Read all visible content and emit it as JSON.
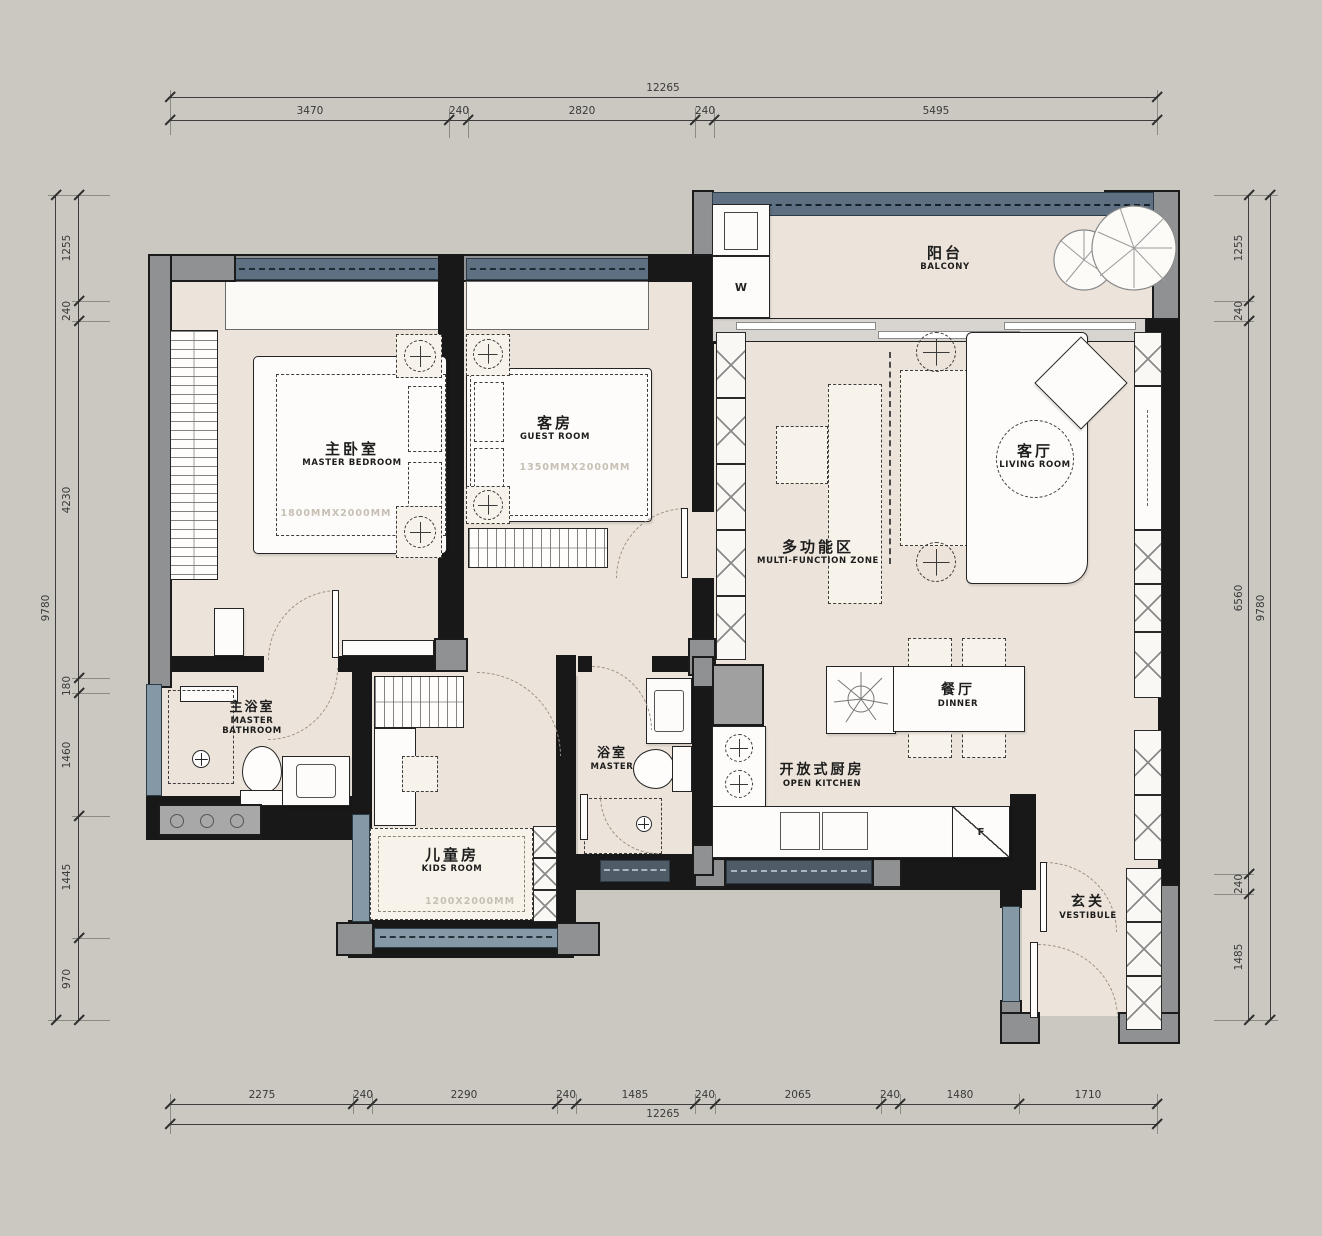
{
  "dims": {
    "top": {
      "total": "12265",
      "segments": [
        "3470",
        "240",
        "2820",
        "240",
        "5495"
      ]
    },
    "bottom": {
      "total": "12265",
      "segments": [
        "2275",
        "240",
        "2290",
        "240",
        "1485",
        "240",
        "2065",
        "240",
        "1480",
        "1710"
      ]
    },
    "left": {
      "total": "9780",
      "segments": [
        "1255",
        "240",
        "4230",
        "180",
        "1460",
        "1445",
        "970"
      ]
    },
    "right": {
      "total": "9780",
      "segments": [
        "1255",
        "240",
        "6560",
        "240",
        "1485"
      ]
    }
  },
  "rooms": {
    "master_bedroom": {
      "zh": "主卧室",
      "en": "MASTER BEDROOM",
      "bed_size": "1800MMX2000MM"
    },
    "guest_room": {
      "zh": "客房",
      "en": "GUEST ROOM",
      "bed_size": "1350MMX2000MM"
    },
    "balcony": {
      "zh": "阳台",
      "en": "BALCONY"
    },
    "living_room": {
      "zh": "客厅",
      "en": "LIVING ROOM"
    },
    "multi_function": {
      "zh": "多功能区",
      "en": "MULTI-FUNCTION ZONE"
    },
    "master_bathroom": {
      "zh": "主浴室",
      "en_line1": "MASTER",
      "en_line2": "BATHROOM"
    },
    "bathroom": {
      "zh": "浴室",
      "en": "MASTER"
    },
    "kids_room": {
      "zh": "儿童房",
      "en": "KIDS ROOM",
      "bed_size": "1200X2000MM"
    },
    "dining": {
      "zh": "餐厅",
      "en": "DINNER"
    },
    "kitchen": {
      "zh": "开放式厨房",
      "en": "OPEN KITCHEN"
    },
    "vestibule": {
      "zh": "玄关",
      "en": "VESTIBULE"
    }
  },
  "appliances": {
    "washer": "W",
    "fridge": "F"
  },
  "colors": {
    "background": "#cbc7c1",
    "floor": "#ece4da",
    "wall": "#181818",
    "column": "#8f9192",
    "window_dark": "#5e7082",
    "window_light": "#8598a6",
    "window_navy": "#4f5b66"
  }
}
